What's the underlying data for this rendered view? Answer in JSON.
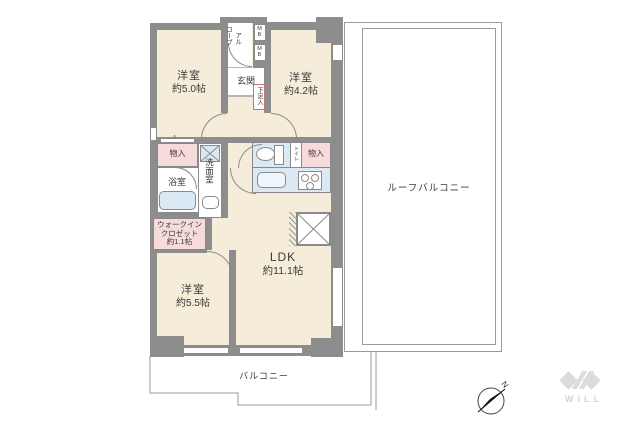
{
  "floor_plan": {
    "unit": {
      "bedroom1": {
        "name": "洋室",
        "size": "約5.0帖"
      },
      "bedroom2": {
        "name": "洋室",
        "size": "約4.2帖"
      },
      "bedroom3": {
        "name": "洋室",
        "size": "約5.5帖"
      },
      "ldk": {
        "name": "LDK",
        "size": "約11.1帖"
      },
      "walk_in_closet": {
        "line1": "ウォークイン",
        "line2": "クロゼット",
        "line3": "約1.1帖"
      },
      "entrance": {
        "label": "玄関"
      },
      "alcove": {
        "text": "アルコーブ",
        "col_right": "アル",
        "col_left": "コーブ"
      },
      "bathroom": {
        "label": "浴室"
      },
      "washroom": {
        "label": "洗面室"
      },
      "toilet": {
        "label": "トイレ"
      },
      "shoe_cabinet": {
        "label": "下足入"
      },
      "storage_left": {
        "label": "物入"
      },
      "storage_right": {
        "label": "物入"
      },
      "meter_box": {
        "label": "MB"
      },
      "folding_door_marker": "∧"
    },
    "outdoor": {
      "roof_balcony": {
        "label": "ルーフバルコニー"
      },
      "balcony": {
        "label": "バルコニー"
      }
    },
    "compass": {
      "north_label": "N"
    },
    "brand": {
      "logo_text": "WILL"
    },
    "colors": {
      "wall": "#8d8d8d",
      "floor": "#f5edda",
      "closet_pink": "#f7dada",
      "water_blue": "#dbe9f5",
      "outline": "#8a8a8a",
      "logo_gray": "#d9d9d9"
    }
  }
}
